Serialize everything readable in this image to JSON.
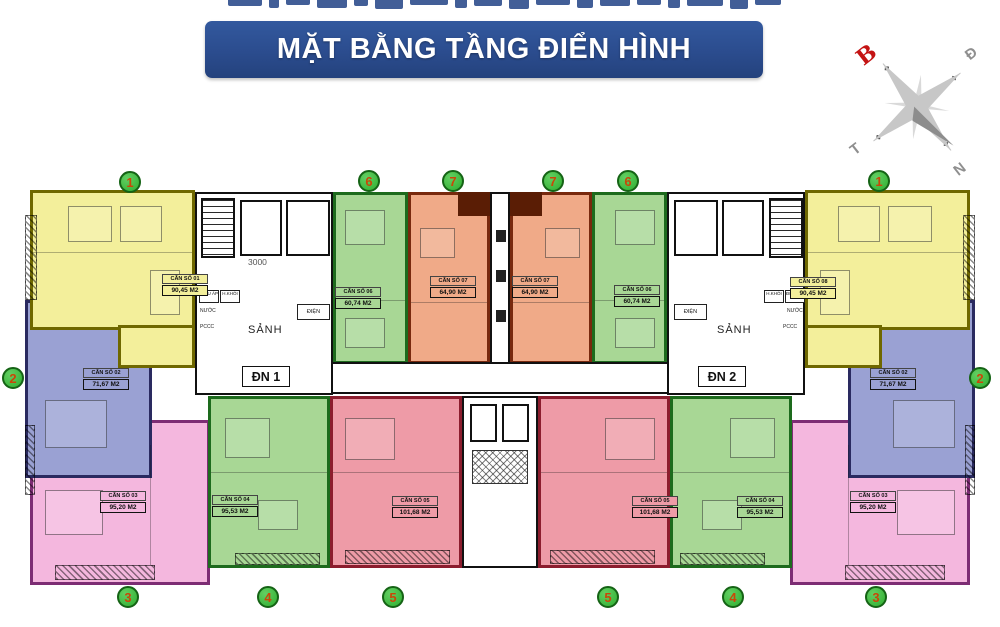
{
  "banner": {
    "title": "MẶT BẰNG TẦNG ĐIỂN HÌNH",
    "bg": "#2b4c8e"
  },
  "compass": {
    "north": "B",
    "east": "Đ",
    "south": "N",
    "west": "T",
    "north_color": "#c41414"
  },
  "cores": {
    "left": {
      "entrance": "ĐN 1",
      "lobby": "SẢNH",
      "dimension": "3000",
      "pressure_duct": "ĐIỀU ÁP",
      "smoke_duct": "H.KHÓI",
      "water": "NƯỚC",
      "fire": "PCCC",
      "electric": "ĐIỆN"
    },
    "right": {
      "entrance": "ĐN 2",
      "lobby": "SẢNH",
      "pressure_duct": "ĐIỀU ÁP",
      "smoke_duct": "H.KHÓI",
      "water": "NƯỚC",
      "fire": "PCCC",
      "electric": "ĐIỆN"
    }
  },
  "circles": [
    "1",
    "6",
    "7",
    "7",
    "6",
    "1",
    "2",
    "2",
    "3",
    "4",
    "5",
    "5",
    "4",
    "3"
  ],
  "units": [
    {
      "name": "CĂN SỐ 01",
      "area": "90,45 M2",
      "type_circle": "1",
      "fill": "#f3ef9b",
      "wall": "#6f6800"
    },
    {
      "name": "CĂN SỐ 06",
      "area": "60,74 M2",
      "type_circle": "6",
      "fill": "#a8d795",
      "wall": "#1d6b1d"
    },
    {
      "name": "CĂN SỐ 07",
      "area": "64,90 M2",
      "type_circle": "7",
      "fill": "#f0aa88",
      "wall": "#78290e"
    },
    {
      "name": "CĂN SỐ 07",
      "area": "64,90 M2",
      "type_circle": "7",
      "fill": "#f0aa88",
      "wall": "#78290e"
    },
    {
      "name": "CĂN SỐ 06",
      "area": "60,74 M2",
      "type_circle": "6",
      "fill": "#a8d795",
      "wall": "#1d6b1d"
    },
    {
      "name": "CĂN SỐ 08",
      "area": "90,45 M2",
      "type_circle": "1",
      "fill": "#f3ef9b",
      "wall": "#6f6800"
    },
    {
      "name": "CĂN SỐ 02",
      "area": "71,67 M2",
      "type_circle": "2",
      "fill": "#9aa1d3",
      "wall": "#2a2a60"
    },
    {
      "name": "CĂN SỐ 02",
      "area": "71,67 M2",
      "type_circle": "2",
      "fill": "#9aa1d3",
      "wall": "#2a2a60"
    },
    {
      "name": "CĂN SỐ 03",
      "area": "95,20 M2",
      "type_circle": "3",
      "fill": "#f4b7de",
      "wall": "#7d2d74"
    },
    {
      "name": "CĂN SỐ 04",
      "area": "95,53 M2",
      "type_circle": "4",
      "fill": "#a8d795",
      "wall": "#1d6b1d"
    },
    {
      "name": "CĂN SỐ 05",
      "area": "101,68 M2",
      "type_circle": "5",
      "fill": "#ee9ba7",
      "wall": "#8c1d2e"
    },
    {
      "name": "CĂN SỐ 05",
      "area": "101,68 M2",
      "type_circle": "5",
      "fill": "#ee9ba7",
      "wall": "#8c1d2e"
    },
    {
      "name": "CĂN SỐ 04",
      "area": "95,53 M2",
      "type_circle": "4",
      "fill": "#a8d795",
      "wall": "#1d6b1d"
    },
    {
      "name": "CĂN SỐ 03",
      "area": "95,20 M2",
      "type_circle": "3",
      "fill": "#f4b7de",
      "wall": "#7d2d74"
    }
  ]
}
